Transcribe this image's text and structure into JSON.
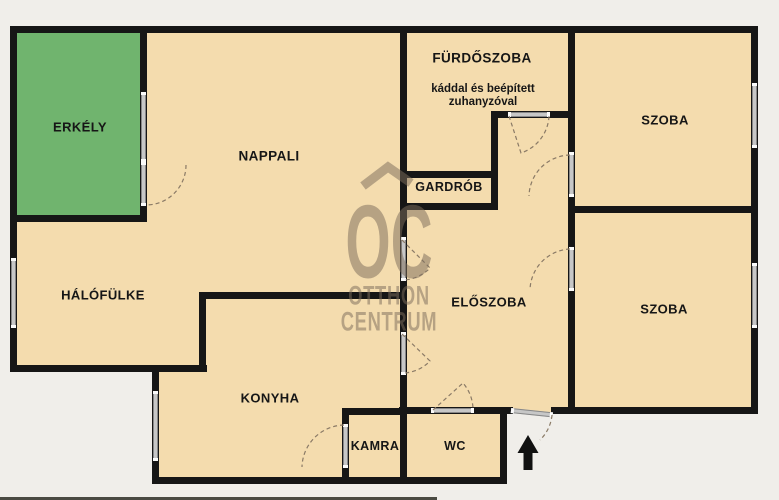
{
  "canvas": {
    "width": 779,
    "height": 500
  },
  "colors": {
    "background": "#f0eeea",
    "room_fill": "#f4dcae",
    "balcony_fill": "#70b46e",
    "wall": "#161616",
    "door_bar": "#c7c7c7",
    "door_arc": "#8a7a66",
    "watermark": "rgba(125,110,92,0.52)",
    "label": "#161616"
  },
  "watermark": {
    "logo": "OC",
    "line2": "OTTHON",
    "line3": "CENTRUM"
  },
  "rooms": {
    "erkely": {
      "label": "ERKÉLY",
      "x": 80,
      "y": 127,
      "fs": 13
    },
    "nappali": {
      "label": "NAPPALI",
      "x": 269,
      "y": 156,
      "fs": 13.5
    },
    "furdoszoba": {
      "label": "FÜRDŐSZOBA",
      "x": 482,
      "y": 58,
      "fs": 13.5,
      "note_line1": "káddal és beépített",
      "note_line2": "zuhanyzóval",
      "note_x": 483,
      "note_y": 96
    },
    "gardrob": {
      "label": "GARDRÓB",
      "x": 449,
      "y": 187,
      "fs": 12.5
    },
    "szoba_felso": {
      "label": "SZOBA",
      "x": 665,
      "y": 120,
      "fs": 13
    },
    "szoba_also": {
      "label": "SZOBA",
      "x": 664,
      "y": 309,
      "fs": 13
    },
    "halofulke": {
      "label": "HÁLÓFÜLKE",
      "x": 103,
      "y": 295,
      "fs": 13
    },
    "eloszoba": {
      "label": "ELŐSZOBA",
      "x": 489,
      "y": 302,
      "fs": 13
    },
    "konyha": {
      "label": "KONYHA",
      "x": 270,
      "y": 398,
      "fs": 13
    },
    "kamra": {
      "label": "KAMRA",
      "x": 375,
      "y": 446,
      "fs": 12.5
    },
    "wc": {
      "label": "WC",
      "x": 455,
      "y": 446,
      "fs": 12.5
    }
  },
  "floorplan_geometry": {
    "floor_rects": [
      {
        "name": "floor-top-band",
        "x": 13,
        "y": 30,
        "w": 741,
        "h": 187
      },
      {
        "name": "floor-middle-band",
        "x": 13,
        "y": 215,
        "w": 741,
        "h": 157
      },
      {
        "name": "floor-lower-band",
        "x": 156,
        "y": 372,
        "w": 598,
        "h": 40
      },
      {
        "name": "floor-bottom-band",
        "x": 156,
        "y": 410,
        "w": 350,
        "h": 71
      }
    ],
    "balcony_rect": {
      "name": "balcony-floor",
      "x": 14,
      "y": 30,
      "w": 130,
      "h": 189
    },
    "walls": [
      {
        "name": "wall-outer-top",
        "x": 10,
        "y": 26,
        "w": 748,
        "h": 7
      },
      {
        "name": "wall-outer-left",
        "x": 10,
        "y": 26,
        "w": 7,
        "h": 346
      },
      {
        "name": "wall-halofulke-bottom",
        "x": 10,
        "y": 365,
        "w": 197,
        "h": 7
      },
      {
        "name": "wall-konyha-west",
        "x": 152,
        "y": 365,
        "w": 7,
        "h": 119
      },
      {
        "name": "wall-outer-bottom",
        "x": 152,
        "y": 477,
        "w": 355,
        "h": 7
      },
      {
        "name": "wall-wc-east",
        "x": 500,
        "y": 407,
        "w": 7,
        "h": 77
      },
      {
        "name": "wall-hall-bottom",
        "x": 399,
        "y": 407,
        "w": 114,
        "h": 7
      },
      {
        "name": "wall-szoba-also-south",
        "x": 551,
        "y": 407,
        "w": 207,
        "h": 7
      },
      {
        "name": "wall-outer-right",
        "x": 751,
        "y": 26,
        "w": 7,
        "h": 388
      },
      {
        "name": "wall-erkely-right",
        "x": 140,
        "y": 26,
        "w": 7,
        "h": 196
      },
      {
        "name": "wall-erkely-bottom",
        "x": 10,
        "y": 215,
        "w": 137,
        "h": 7
      },
      {
        "name": "wall-central-vertical",
        "x": 400,
        "y": 26,
        "w": 7,
        "h": 458
      },
      {
        "name": "wall-szoba-west-vertical",
        "x": 568,
        "y": 26,
        "w": 7,
        "h": 388
      },
      {
        "name": "wall-furdo-bottom",
        "x": 493,
        "y": 111,
        "w": 82,
        "h": 7
      },
      {
        "name": "wall-gardrob-east",
        "x": 491,
        "y": 111,
        "w": 7,
        "h": 99
      },
      {
        "name": "wall-gardrob-top",
        "x": 400,
        "y": 171,
        "w": 97,
        "h": 7
      },
      {
        "name": "wall-gardrob-bottom",
        "x": 400,
        "y": 203,
        "w": 97,
        "h": 7
      },
      {
        "name": "wall-szoba-divider",
        "x": 568,
        "y": 206,
        "w": 190,
        "h": 7
      },
      {
        "name": "wall-konyha-top",
        "x": 199,
        "y": 292,
        "w": 208,
        "h": 7
      },
      {
        "name": "wall-konyha-nw-step",
        "x": 199,
        "y": 292,
        "w": 7,
        "h": 80
      },
      {
        "name": "wall-kamra-top",
        "x": 342,
        "y": 408,
        "w": 65,
        "h": 7
      },
      {
        "name": "wall-kamra-west",
        "x": 342,
        "y": 408,
        "w": 7,
        "h": 76
      }
    ],
    "windows": [
      {
        "name": "window-erkely",
        "x": 141,
        "y": 92,
        "w": 5,
        "h": 70
      },
      {
        "name": "window-halofulke",
        "x": 11,
        "y": 258,
        "w": 5,
        "h": 70
      },
      {
        "name": "window-konyha",
        "x": 153,
        "y": 391,
        "w": 5,
        "h": 70
      },
      {
        "name": "window-szoba-felso",
        "x": 752,
        "y": 83,
        "w": 5,
        "h": 65
      },
      {
        "name": "window-szoba-also",
        "x": 752,
        "y": 263,
        "w": 5,
        "h": 65
      }
    ],
    "door_bars": [
      {
        "name": "door-erkely",
        "x": 141,
        "y": 162,
        "w": 5,
        "h": 44
      },
      {
        "name": "door-furdoszoba",
        "x": 508,
        "y": 112,
        "w": 42,
        "h": 5
      },
      {
        "name": "door-szoba-felso",
        "x": 569,
        "y": 152,
        "w": 5,
        "h": 45
      },
      {
        "name": "door-nappali",
        "x": 401,
        "y": 237,
        "w": 5,
        "h": 44
      },
      {
        "name": "door-konyha",
        "x": 401,
        "y": 332,
        "w": 5,
        "h": 43
      },
      {
        "name": "door-szoba-also",
        "x": 569,
        "y": 247,
        "w": 5,
        "h": 44
      },
      {
        "name": "door-wc",
        "x": 431,
        "y": 408,
        "w": 43,
        "h": 5
      },
      {
        "name": "door-entrance",
        "x": 511,
        "y": 408,
        "w": 42,
        "h": 5,
        "rot": 6
      },
      {
        "name": "door-kamra",
        "x": 343,
        "y": 424,
        "w": 5,
        "h": 44
      }
    ],
    "door_arcs": [
      {
        "name": "arc-erkely",
        "d": "M186,165 A40,40 0 0 1 146,205"
      },
      {
        "name": "arc-furdoszoba",
        "d": "M509,116 L521,153 A41,41 0 0 0 549,116"
      },
      {
        "name": "arc-szoba-felso",
        "d": "M570,155 A42,42 0 0 0 529,196"
      },
      {
        "name": "arc-nappali",
        "d": "M402,240 L430,268 A40,40 0 0 1 404,280"
      },
      {
        "name": "arc-konyha",
        "d": "M402,334 L430,361 A39,39 0 0 1 404,373"
      },
      {
        "name": "arc-szoba-also",
        "d": "M570,249 A42,42 0 0 0 530,290"
      },
      {
        "name": "arc-wc",
        "d": "M433,410 L463,383 A41,41 0 0 1 473,409"
      },
      {
        "name": "arc-entrance",
        "d": "M552,415 A40,40 0 0 1 540,440"
      },
      {
        "name": "arc-kamra",
        "d": "M344,425 A43,43 0 0 0 302,467"
      }
    ],
    "entrance_arrow": "M528,435 L538.5,453 L532.5,453 L532.5,470 L523.5,470 L523.5,453 L517.5,453 Z",
    "watermark_roof": "M363,186 L388,167 L411,183",
    "watermark_pos": {
      "oc_x": 389,
      "oc_y": 243,
      "line2_x": 389,
      "line2_y": 296,
      "line3_x": 389,
      "line3_y": 322
    },
    "edge_artifact": {
      "x": 0,
      "y": 497,
      "w": 437,
      "h": 3
    }
  }
}
